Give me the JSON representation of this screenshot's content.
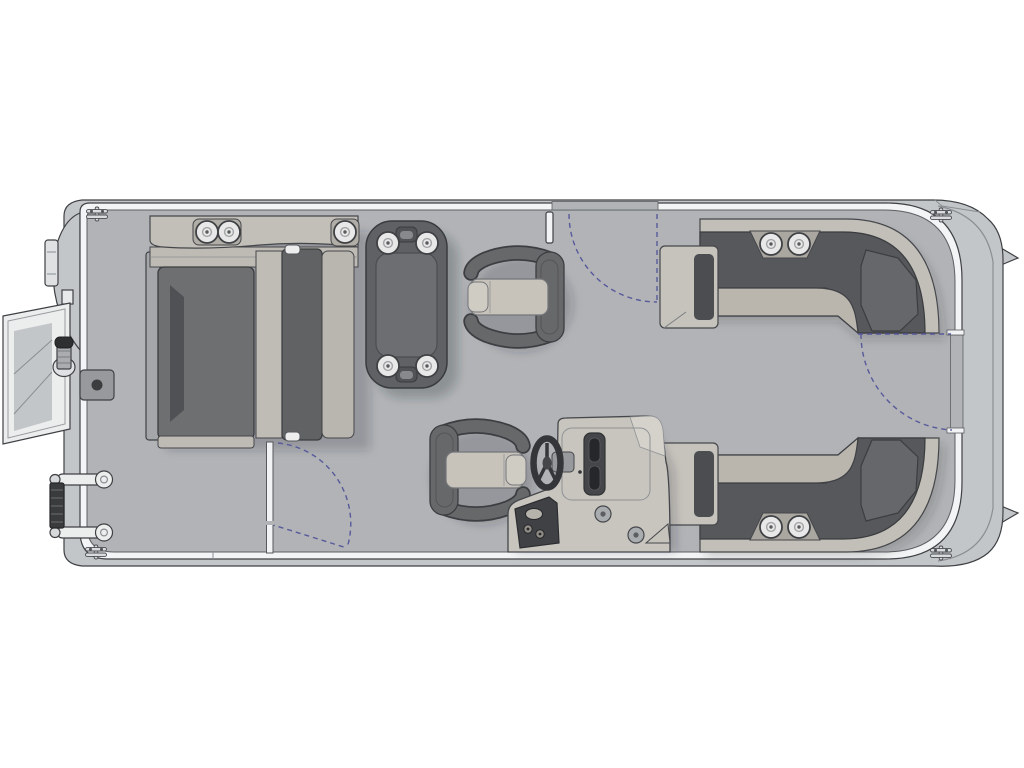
{
  "diagram": {
    "kind": "pontoon-boat-floor-plan-top-view",
    "orientation": "bow-left-stern-right"
  },
  "colors": {
    "page_bg": "#ffffff",
    "hull": "#c3c6c9",
    "rail": "#f3f4f5",
    "deck": "#b1b3b6",
    "outline": "#3f4145",
    "charcoal": "#57585b",
    "seat_light": "#c2bfb8",
    "seat_band": "#bebbb4",
    "cushion_dark": "#6e6f71",
    "table": "#5f6164",
    "table_inner": "#6c6e71",
    "chair_body": "#67686a",
    "chair_seat": "#c7c3bb",
    "console_body": "#c8c5be",
    "panel_dark": "#404144",
    "cupholder": "#e7e8e7",
    "white_part": "#ededee",
    "gate_swing": "#585a9b",
    "shadow": "rgba(40,42,48,0.22)"
  },
  "components": {
    "bow_boarding_gate": {
      "icon": "bow-gate-ladder-icon",
      "location": "bow"
    },
    "bow_nav_light": {
      "icon": "nav-light-icon"
    },
    "stowed_side_ladder": {
      "icon": "boarding-ladder-icon",
      "rungs": 2
    },
    "deck_hatch": {
      "icon": "deck-hatch-icon"
    },
    "mooring_cleats": {
      "icon": "mooring-cleat-icon",
      "count": 4
    },
    "bow_lounge": {
      "cupholders": 3
    },
    "pedestal_table": {
      "cupholders": 4
    },
    "forward_captain_chair": {
      "facing": "bow"
    },
    "helm_chair": {
      "facing": "helm"
    },
    "helm_console": {
      "icon": "steering-wheel-icon",
      "gauges": 2,
      "speakers": 2
    },
    "stern_lounge_port": {
      "cupholders": 2
    },
    "stern_lounge_starboard": {
      "cupholders": 2
    },
    "swing_gates": {
      "count": 3,
      "style": "dashed-arc"
    }
  }
}
